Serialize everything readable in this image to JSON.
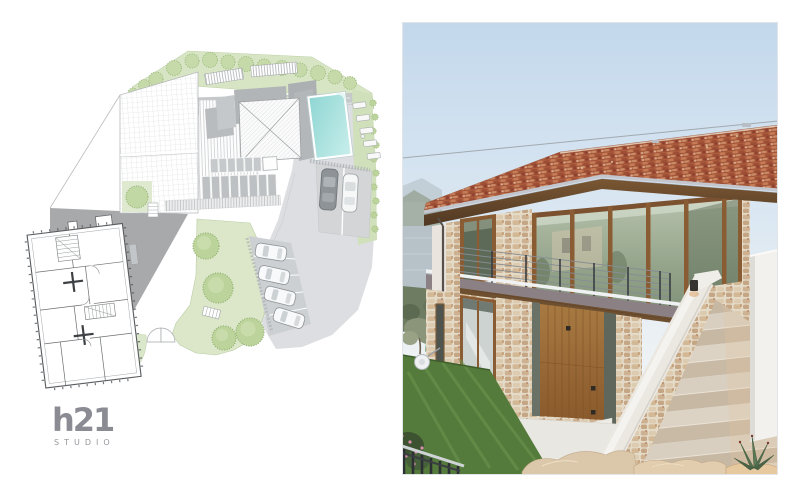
{
  "logo": {
    "name": "h21",
    "sub": "STUDIO",
    "color": "#8b8b93"
  },
  "site_plan": {
    "title": "architectural site plan",
    "features": [
      "row-of-trees",
      "terraced-garden",
      "gridded-roof",
      "hip-roof",
      "standing-seam-roof",
      "solar-panels",
      "swimming-pool",
      "sun-loungers",
      "parking-two-cars",
      "angled-parking-four-cars",
      "driveway",
      "lawn-with-trees",
      "entrance-gate",
      "floor-plan-building"
    ],
    "colors": {
      "paving": "#dcdee1",
      "driveway": "#a7a9ab",
      "lawn": "#dbe7c8",
      "tree": "#c2d8a4",
      "pool": "#8fd6d3",
      "lines": "#9b9ea1"
    }
  },
  "photo": {
    "title": "villa photograph",
    "features": [
      "sky",
      "power-line",
      "mountains",
      "lake",
      "olive-tree",
      "terracotta-tile-roof",
      "wood-beam",
      "glass-facade",
      "stone-piers",
      "balcony-cable-railing",
      "balcony-band",
      "wood-entry-door",
      "glass-doors",
      "white-stair-parapet",
      "stone-staircase",
      "terrace",
      "white-parapet-wall",
      "wall-lamp",
      "lawn",
      "garden-railing",
      "cable-reel",
      "flower-bush",
      "rocks",
      "agave"
    ],
    "colors": {
      "sky": "#c3d8ec",
      "roof": "#b06040",
      "wood": "#8a5c33",
      "stone": "#d3b896",
      "glass": "#94a48b",
      "lawn": "#547b3b",
      "parapet": "#ebe8e2",
      "band": "#8b8185"
    }
  }
}
